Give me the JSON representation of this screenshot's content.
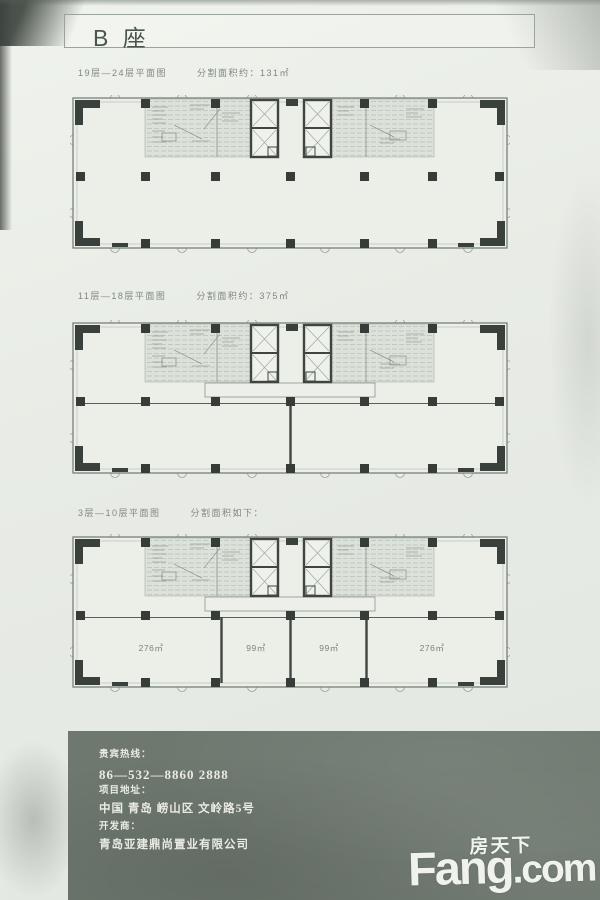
{
  "page": {
    "title": "B 座"
  },
  "plans": [
    {
      "floors": "19层—24层平面图",
      "area_note": "分割面积约：131㎡"
    },
    {
      "floors": "11层—18层平面图",
      "area_note": "分割面积约：375㎡"
    },
    {
      "floors": "3层—10层平面图",
      "area_note": "分割面积如下：",
      "rooms": [
        "276㎡",
        "99㎡",
        "99㎡",
        "276㎡"
      ]
    }
  ],
  "contact": {
    "hotline_label": "贵宾热线：",
    "hotline_number": "86—532—8860 2888",
    "address_label": "项目地址：",
    "address_value": "中国 青岛 崂山区 文岭路5号",
    "developer_label": "开发商：",
    "developer_value": "青岛亚建鼎尚置业有限公司"
  },
  "watermark": {
    "cn": "房天下",
    "en_main": "Fang",
    "en_suffix": ".com"
  },
  "colors": {
    "paper": "#e9ece6",
    "plan_line": "#4a524c",
    "column": "#3a413c",
    "footer_bg": "#6e786f",
    "footer_text": "#e9ebe3",
    "watermark_text": "#f4f6f1"
  }
}
